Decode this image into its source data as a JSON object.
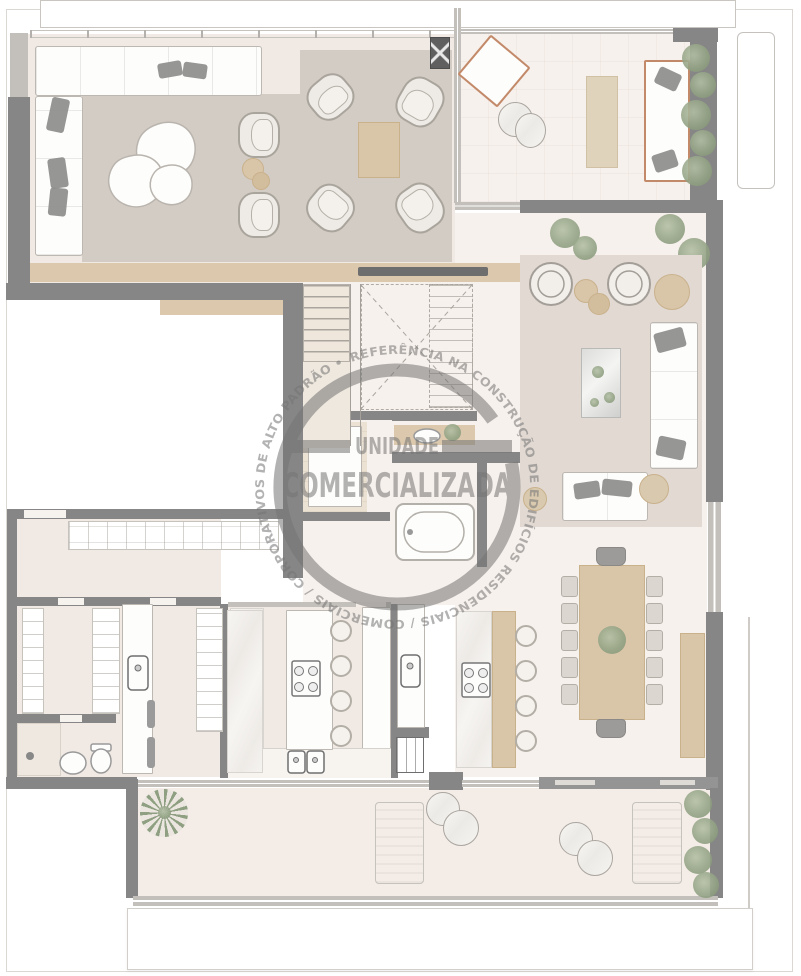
{
  "watermark": {
    "line1": "UNIDADE",
    "line2": "COMERCIALIZADA",
    "ring": "REFERÊNCIA NA CONSTRUÇÃO DE EDIFÍCIOS RESIDENCIAIS / COMERCIAIS / CORPORATIVOS DE ALTO PADRÃO • "
  },
  "palette": {
    "wall": "#868686",
    "wall_light": "#c3bfba",
    "floor": "#f1eae4",
    "floor_pale": "#f7f1ed",
    "rug": "#d3ccc4",
    "wood": "#d9c5a8",
    "wood_deep": "#c9b18c",
    "terracotta": "#c38a6a",
    "plant": "#93a385",
    "marble": "#f6f4f1",
    "stamp": "#757575",
    "line": "#bcb7b1",
    "white": "#fdfdfc"
  }
}
